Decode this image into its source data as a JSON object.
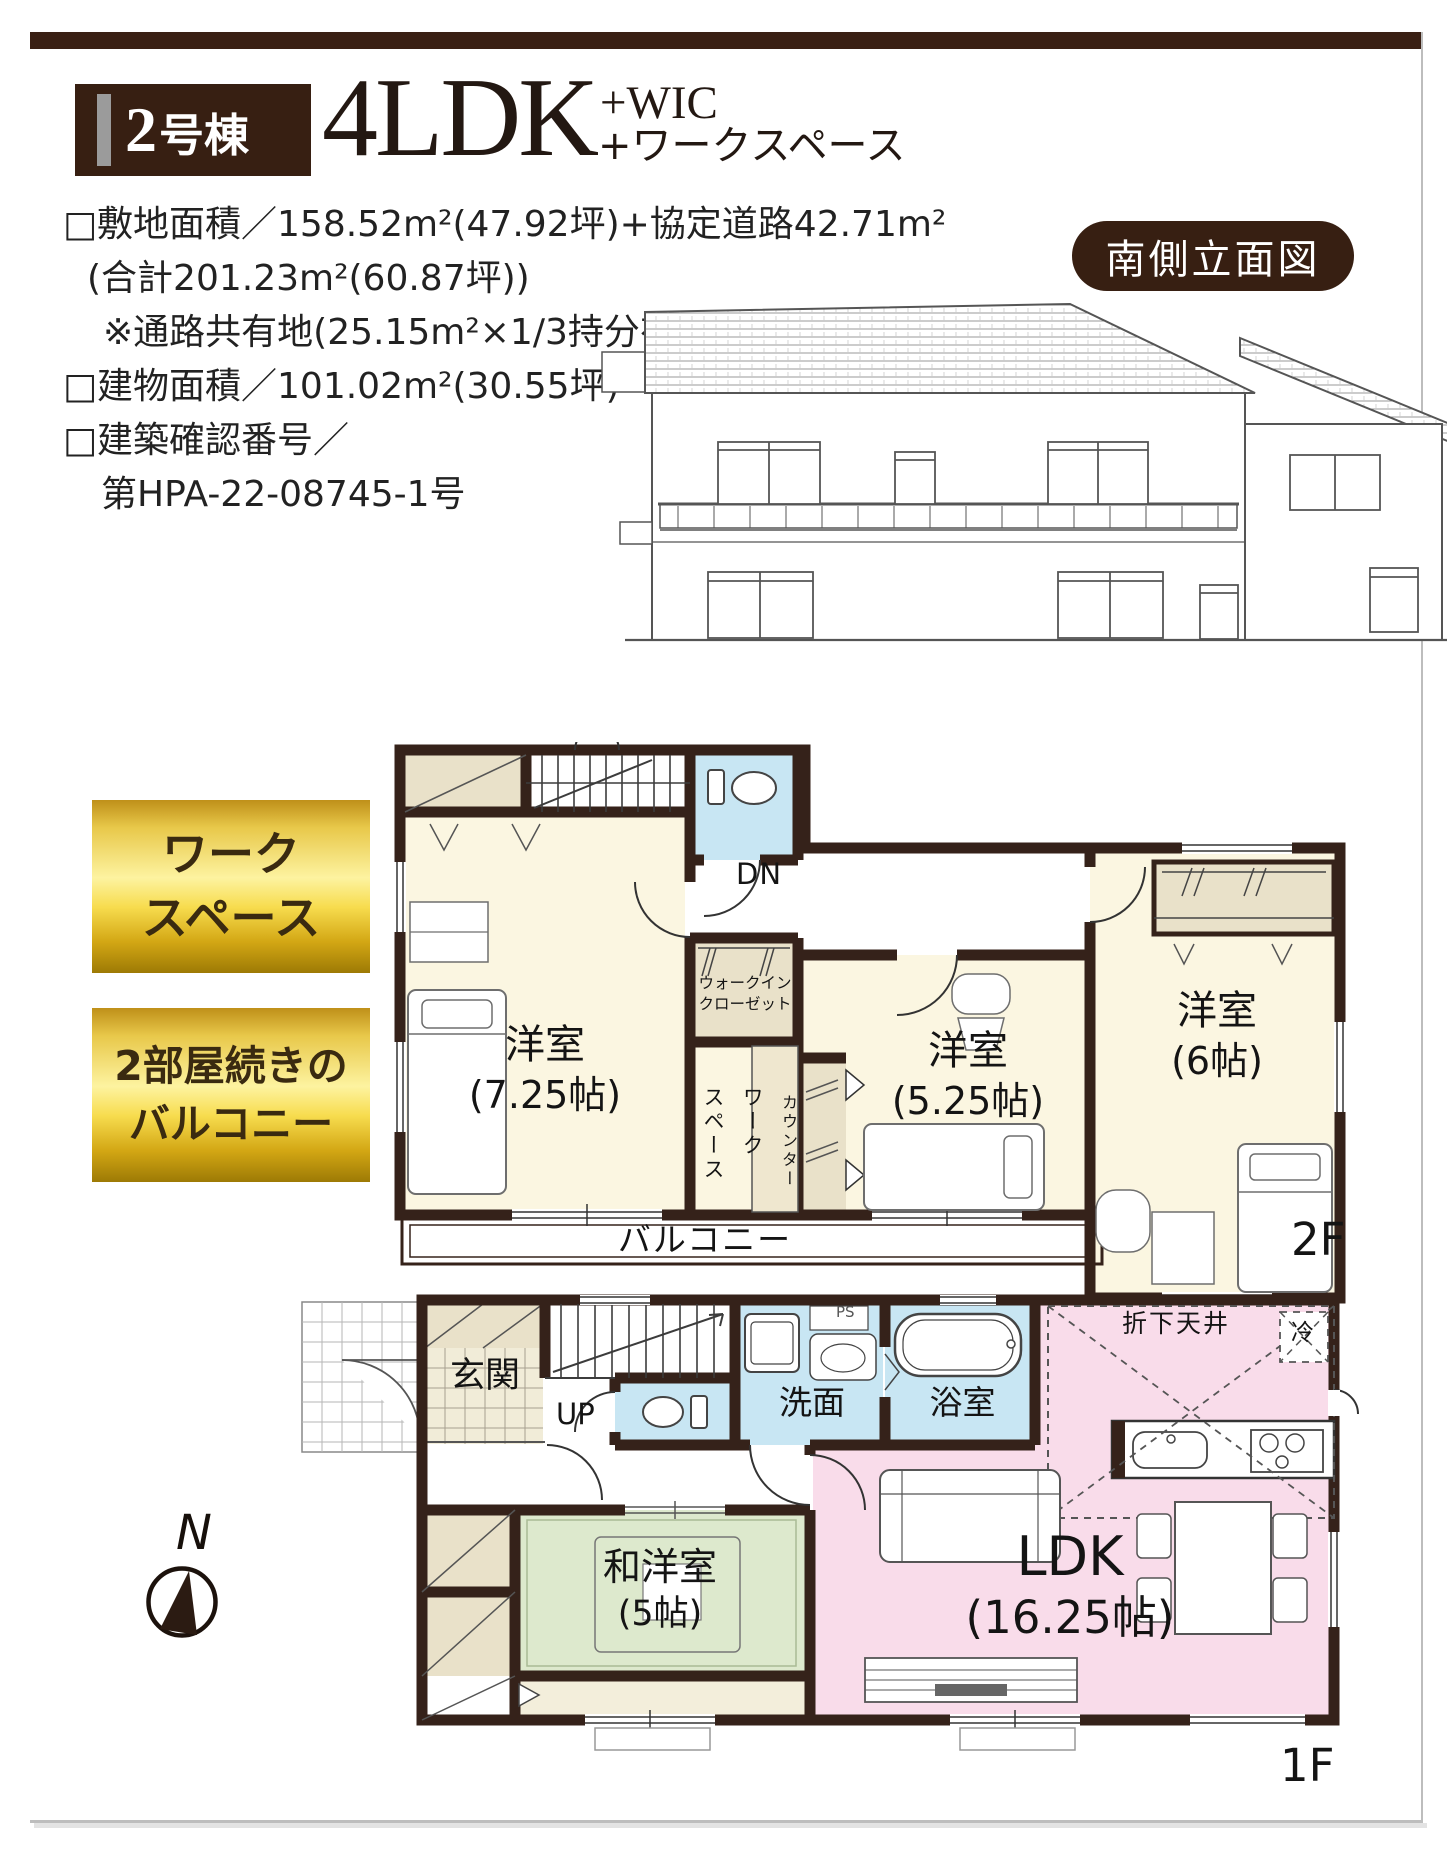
{
  "header": {
    "unit_num": "2",
    "unit_suffix": "号棟",
    "plan_main": "4LDK",
    "plan_sub1": "+WIC",
    "plan_sub2": "+ワークスペース"
  },
  "specs": {
    "lines": [
      "□敷地面積／158.52m²(47.92坪)+協定道路42.71m²",
      "(合計201.23m²(60.87坪))",
      "※通路共有地(25.15m²×1/3持分有)",
      "□建物面積／101.02m²(30.55坪)",
      "□建築確認番号／",
      "第HPA-22-08745-1号"
    ]
  },
  "elevation": {
    "badge": "南側立面図"
  },
  "features": {
    "badge1_line1": "ワーク",
    "badge1_line2": "スペース",
    "badge2_line1": "2部屋続きの",
    "badge2_line2": "バルコニー"
  },
  "floor2": {
    "floor_label": "2F",
    "stairs_dn": "DN",
    "west_room_name": "洋室",
    "west_room_size": "(7.25帖)",
    "mid_room_name": "洋室",
    "mid_room_size": "(5.25帖)",
    "east_room_name": "洋室",
    "east_room_size": "(6帖)",
    "wic_line1": "ウォークイン",
    "wic_line2": "クローゼット",
    "workspace_line1": "ワーク",
    "workspace_line2": "スペース",
    "counter": "カウンター",
    "balcony": "バルコニー"
  },
  "floor1": {
    "floor_label": "1F",
    "stairs_up": "UP",
    "ps": "PS",
    "entrance": "玄関",
    "washroom": "洗面",
    "bathroom": "浴室",
    "jp_room_name": "和洋室",
    "jp_room_size": "(5帖)",
    "ldk_name": "LDK",
    "ldk_size": "(16.25帖)",
    "dropped_ceiling": "折下天井",
    "fridge": "冷"
  },
  "compass": {
    "north": "N"
  },
  "colors": {
    "brand_brown": "#3a2014",
    "wall": "#35221a",
    "room_cream": "#fbf6e1",
    "wet_blue": "#c8e6f3",
    "ldk_pink": "#f9dcea",
    "tatami_green": "#dde9cd",
    "closet_beige": "#e9e1c9",
    "gold_text": "#3a2a10"
  }
}
